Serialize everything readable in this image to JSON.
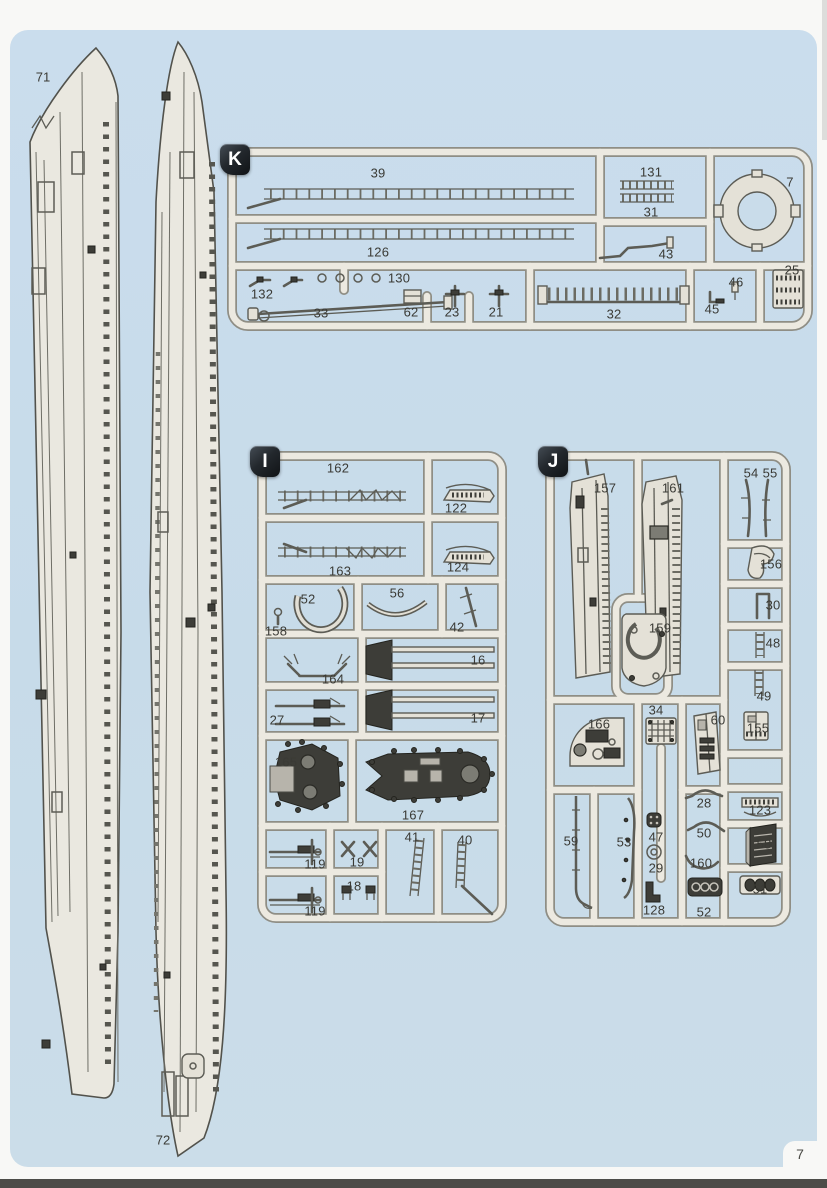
{
  "page": {
    "number": "7"
  },
  "hulls": {
    "left_label": "71",
    "right_label": "72"
  },
  "sprues": {
    "k": {
      "badge": "K",
      "labels": [
        "39",
        "126",
        "131",
        "31",
        "43",
        "7",
        "132",
        "130",
        "33",
        "62",
        "23",
        "21",
        "32",
        "45",
        "46",
        "25"
      ]
    },
    "i": {
      "badge": "I",
      "labels": [
        "162",
        "122",
        "163",
        "124",
        "52",
        "158",
        "56",
        "42",
        "164",
        "16",
        "27",
        "17",
        "165",
        "167",
        "119",
        "19",
        "41",
        "40",
        "18",
        "119"
      ]
    },
    "j": {
      "badge": "J",
      "labels": [
        "157",
        "161",
        "54",
        "55",
        "156",
        "30",
        "48",
        "49",
        "159",
        "166",
        "34",
        "60",
        "155",
        "28",
        "123",
        "59",
        "53",
        "47",
        "29",
        "128",
        "50",
        "160",
        "52",
        "58",
        "51"
      ]
    }
  },
  "colors": {
    "page_blue": "#c9dcea",
    "plastic": "#ece9e0",
    "badge_dark": "#1c2024",
    "edge_dark": "#4c4c48"
  }
}
